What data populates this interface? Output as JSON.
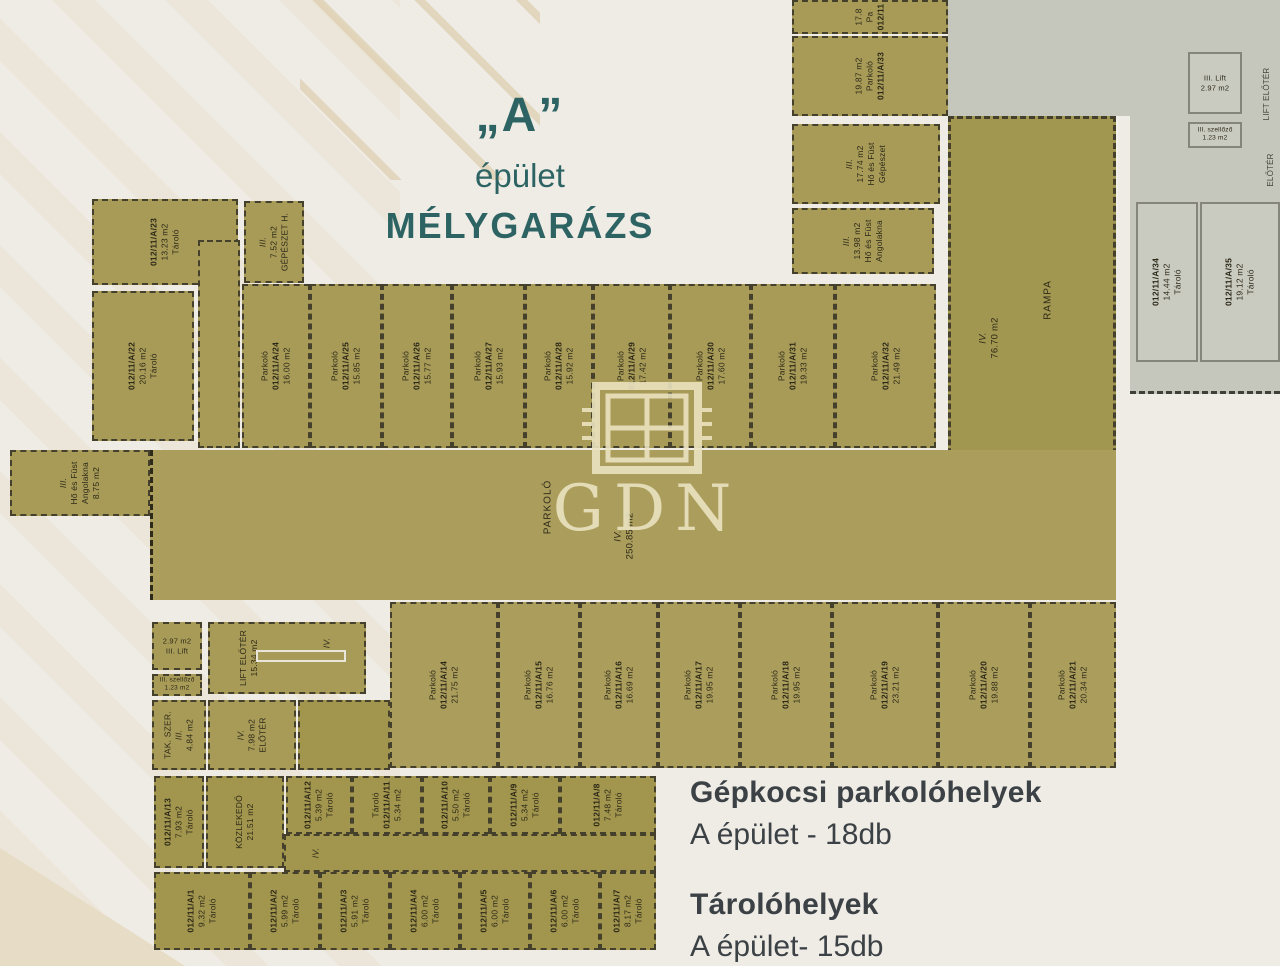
{
  "header": {
    "quoted_letter": "„A”",
    "building": "épület",
    "subtitle": "MÉLYGARÁZS"
  },
  "watermark": {
    "text": "GDN"
  },
  "summary": {
    "parking_heading": "Gépkocsi parkolóhelyek",
    "parking_line": "A épület - 18db",
    "storage_heading": "Tárolóhelyek",
    "storage_line": "A épület- 15db"
  },
  "colors": {
    "accent_teal": "#2d6463",
    "plan_olive": "#a89b58",
    "adjacent_gray": "#c5c6bc",
    "text_dark": "#3b4145",
    "watermark_cream": "#ebe3c0"
  },
  "rooms": [
    {
      "key": "a23",
      "lines": [
        "**012/11/A/23",
        "13.23 m2",
        "Tároló"
      ]
    },
    {
      "key": "gepH",
      "lines": [
        "III.",
        "7.52 m2",
        "GÉPÉSZET H."
      ]
    },
    {
      "key": "a22",
      "lines": [
        "**012/11/A/22",
        "20.16 m2",
        "Tároló"
      ]
    },
    {
      "key": "corL",
      "lines": []
    },
    {
      "key": "a24",
      "lines": [
        "Parkoló",
        "**012/11/A/24",
        "16.00 m2"
      ]
    },
    {
      "key": "a25",
      "lines": [
        "Parkoló",
        "**012/11/A/25",
        "15.85 m2"
      ]
    },
    {
      "key": "a26",
      "lines": [
        "Parkoló",
        "**012/11/A/26",
        "15.77 m2"
      ]
    },
    {
      "key": "a27",
      "lines": [
        "Parkoló",
        "**012/11/A/27",
        "15.93 m2"
      ]
    },
    {
      "key": "a28",
      "lines": [
        "Parkoló",
        "**012/11/A/28",
        "15.92 m2"
      ]
    },
    {
      "key": "a29",
      "lines": [
        "Parkoló",
        "**012/11/A/29",
        "17.42 m2"
      ]
    },
    {
      "key": "a30",
      "lines": [
        "Parkoló",
        "**012/11/A/30",
        "17.60 m2"
      ]
    },
    {
      "key": "a31",
      "lines": [
        "Parkoló",
        "**012/11/A/31",
        "19.33 m2"
      ]
    },
    {
      "key": "a32",
      "lines": [
        "Parkoló",
        "**012/11/A/32",
        "21.49 m2"
      ]
    },
    {
      "key": "pTop",
      "lines": [
        "17.8",
        "Pa",
        "**012/11"
      ]
    },
    {
      "key": "a33",
      "lines": [
        "19.87 m2",
        "Parkoló",
        "**012/11/A/33"
      ]
    },
    {
      "key": "hfG",
      "lines": [
        "III.",
        "17.74 m2",
        "Hő és Füst",
        "Gépészet"
      ]
    },
    {
      "key": "hfA2",
      "lines": [
        "III.",
        "13.98 m2",
        "Hő és Füst",
        "Angolakna"
      ]
    },
    {
      "key": "rampa",
      "lines": [
        "IV.",
        "76.70 m2"
      ],
      "lines2": [
        "RAMPA"
      ]
    },
    {
      "key": "hfA1",
      "lines": [
        "III.",
        "Hő és Füst",
        "Angolakna",
        "8.75 m2"
      ]
    },
    {
      "key": "hall",
      "lines": [
        "PARKOLÓ"
      ],
      "lines2": [
        "IV.",
        "250.85 m2"
      ]
    },
    {
      "key": "a14",
      "lines": [
        "Parkoló",
        "**012/11/A/14",
        "21.75 m2"
      ]
    },
    {
      "key": "a15",
      "lines": [
        "Parkoló",
        "**012/11/A/15",
        "16.76 m2"
      ]
    },
    {
      "key": "a16",
      "lines": [
        "Parkoló",
        "**012/11/A/16",
        "16.69 m2"
      ]
    },
    {
      "key": "a17",
      "lines": [
        "Parkoló",
        "**012/11/A/17",
        "19.95 m2"
      ]
    },
    {
      "key": "a18",
      "lines": [
        "Parkoló",
        "**012/11/A/18",
        "19.95 m2"
      ]
    },
    {
      "key": "a19",
      "lines": [
        "Parkoló",
        "**012/11/A/19",
        "23.21 m2"
      ]
    },
    {
      "key": "a20",
      "lines": [
        "Parkoló",
        "**012/11/A/20",
        "19.88 m2"
      ]
    },
    {
      "key": "a21",
      "lines": [
        "Parkoló",
        "**012/11/A/21",
        "20.34 m2"
      ]
    },
    {
      "key": "lift",
      "lines": [
        "2.97 m2",
        "III.  Lift"
      ]
    },
    {
      "key": "liftE",
      "lines": [
        "LIFT ELŐTÉR",
        "15.34 m2"
      ],
      "lines2": [
        "IV."
      ]
    },
    {
      "key": "szel",
      "lines": [
        "III. szellőző",
        "1.23 m2"
      ]
    },
    {
      "key": "tak",
      "lines": [
        "TAK. SZER.",
        "III.",
        "4.84 m2"
      ]
    },
    {
      "key": "elo",
      "lines": [
        "IV.",
        "7.98 m2",
        "ELŐTÉR"
      ]
    },
    {
      "key": "corS",
      "lines": []
    },
    {
      "key": "a13",
      "lines": [
        "**012/11/A/13",
        "7.93 m2",
        "Tároló"
      ]
    },
    {
      "key": "koz",
      "lines": [
        "KÖZLEKEDŐ",
        "21.51 m2"
      ]
    },
    {
      "key": "cIV",
      "lines": [
        "IV."
      ]
    },
    {
      "key": "a12",
      "lines": [
        "**012/11/A/12",
        "5.39 m2",
        "Tároló"
      ]
    },
    {
      "key": "a11",
      "lines": [
        "Tároló",
        "**012/11/A/11",
        "5.34 m2"
      ]
    },
    {
      "key": "a10",
      "lines": [
        "**012/11/A/10",
        "5.50 m2",
        "Tároló"
      ]
    },
    {
      "key": "a9",
      "lines": [
        "**012/11/A/9",
        "5.34 m2",
        "Tároló"
      ]
    },
    {
      "key": "a8",
      "lines": [
        "**012/11/A/8",
        "7.48 m2",
        "Tároló"
      ]
    },
    {
      "key": "a1",
      "lines": [
        "**012/11/A/1",
        "9.32 m2",
        "Tároló"
      ]
    },
    {
      "key": "a2",
      "lines": [
        "**012/11/A/2",
        "5.99 m2",
        "Tároló"
      ]
    },
    {
      "key": "a3",
      "lines": [
        "**012/11/A/3",
        "5.91 m2",
        "Tároló"
      ]
    },
    {
      "key": "a4",
      "lines": [
        "**012/11/A/4",
        "6.00 m2",
        "Tároló"
      ]
    },
    {
      "key": "a5",
      "lines": [
        "**012/11/A/5",
        "6.00 m2",
        "Tároló"
      ]
    },
    {
      "key": "a6",
      "lines": [
        "**012/11/A/6",
        "6.00 m2",
        "Tároló"
      ]
    },
    {
      "key": "a7",
      "lines": [
        "**012/11/A/7",
        "8.17 m2",
        "Tároló"
      ]
    },
    {
      "key": "gLift",
      "lines": [
        "III.  Lift",
        "2.97 m2"
      ]
    },
    {
      "key": "gSzel",
      "lines": [
        "III. szellőző",
        "1.23 m2"
      ]
    },
    {
      "key": "gLiftE",
      "lines": [
        "LIFT ELŐTÉR"
      ]
    },
    {
      "key": "gElo",
      "lines": [
        "ELŐTÉR"
      ]
    },
    {
      "key": "a34",
      "lines": [
        "**012/11/A/34",
        "14.44 m2",
        "Tároló"
      ]
    },
    {
      "key": "a35",
      "lines": [
        "**012/11/A/35",
        "19.12 m2",
        "Tároló"
      ]
    }
  ]
}
